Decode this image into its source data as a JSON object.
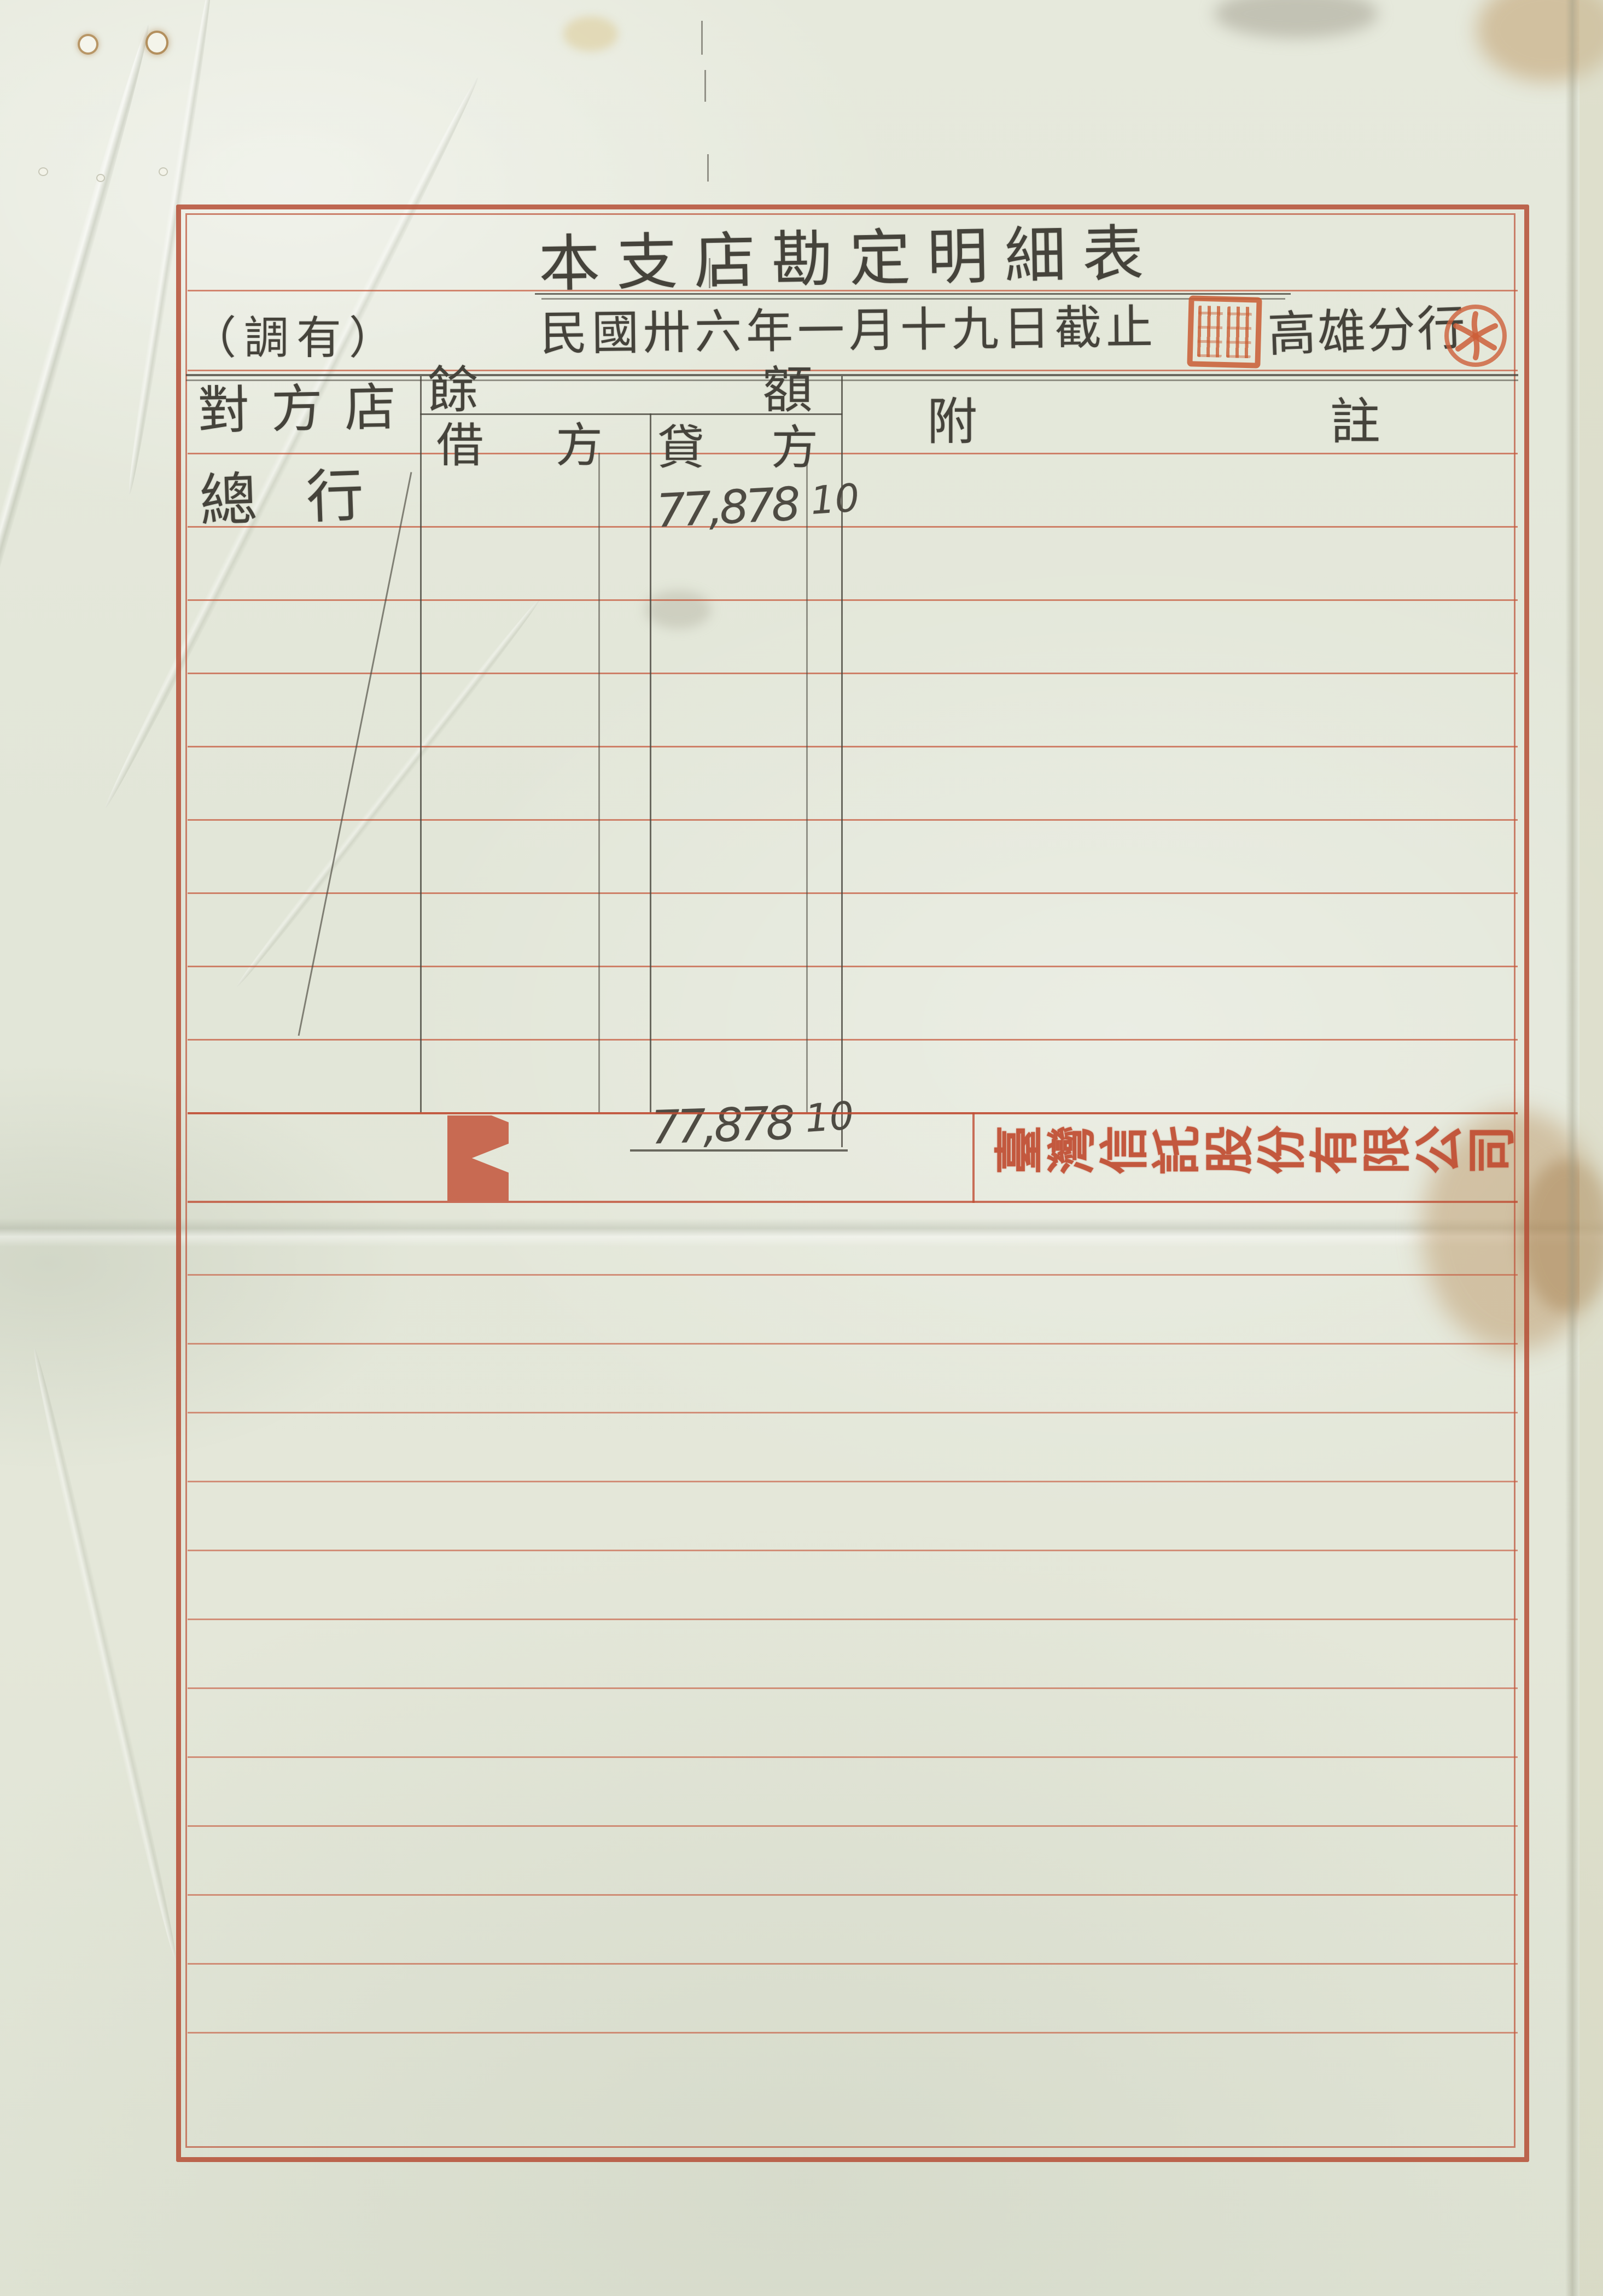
{
  "document": {
    "title": "本支店勘定明細表",
    "date_line": "民國卅六年一月十九日截止",
    "corner_annotation": "（調有）",
    "branch_name": "高雄分行",
    "company_name": "臺灣信託股份有限公司"
  },
  "table": {
    "headers": {
      "counterparty": "對方店",
      "balance": "餘額",
      "debit": "借方",
      "credit": "貸方",
      "notes": "附註"
    },
    "rows": [
      {
        "counterparty": "總行",
        "debit": "",
        "credit_main": "77,878",
        "credit_cents": "10",
        "notes": ""
      }
    ],
    "total": {
      "credit_main": "77,878",
      "credit_cents": "10"
    }
  },
  "seals": {
    "square_seal": {
      "shape": "square",
      "color": "#c95c32",
      "script": "seal-script, illegible"
    },
    "round_seal": {
      "shape": "round",
      "color": "#cd5f3a",
      "motif": "pinwheel character"
    }
  },
  "colors": {
    "paper": "#e4e8db",
    "frame_red": "#b54e35",
    "ruled_red": "#c6583c",
    "pencil_gray": "#45433b",
    "stamp_red": "#c3543a"
  }
}
